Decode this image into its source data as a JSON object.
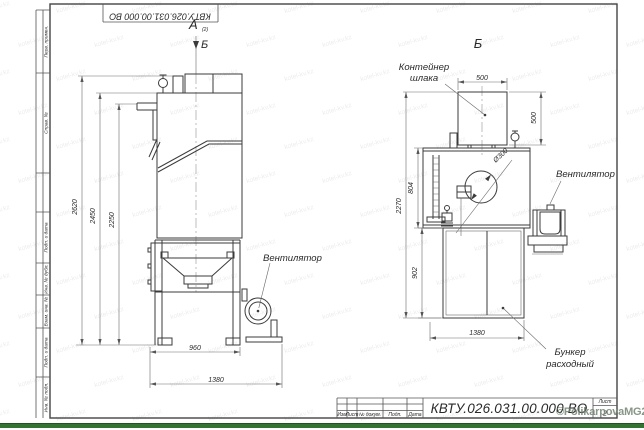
{
  "watermark": {
    "text": "kotel-kv.kz"
  },
  "copyright": "©PolikarpovaMG2021",
  "frame": {
    "doc_number_top": "КВТУ.026.031.00.000 ВО",
    "stamps": [
      "Перв. примен.",
      "Справ. №",
      "Подп. и дата",
      "Инв. № дубл.",
      "Взам. инв. №",
      "Подп. и дата",
      "Инв. № подл."
    ]
  },
  "title_block": {
    "header_cols": {
      "izm": "Изм",
      "list": "Лист",
      "doc": "№ докум.",
      "podp": "Подп.",
      "data": "Дата"
    },
    "doc_number": "КВТУ.026.031.00.000 ВО",
    "sheet_label": "Лист",
    "sheet_number": "2"
  },
  "views": {
    "front": {
      "label_a": "А",
      "label_a_sub": "(2)",
      "label_b_arrow": "Б",
      "fan_label": "Вентилятор",
      "dims": {
        "h_total": "2620",
        "h_body": "2450",
        "h_pipe": "2250",
        "w_stand": "960",
        "w_total": "1380"
      }
    },
    "side": {
      "label": "Б",
      "container_label_1": "Контейнер",
      "container_label_2": "шлака",
      "fan_label": "Вентилятор",
      "bunker_label_1": "Бункер",
      "bunker_label_2": "расходный",
      "dims": {
        "container_w": "500",
        "container_h": "500",
        "body_h": "804",
        "total_h": "2270",
        "bunker_h": "902",
        "bunker_w": "1380",
        "diameter": "Ø300"
      }
    }
  }
}
